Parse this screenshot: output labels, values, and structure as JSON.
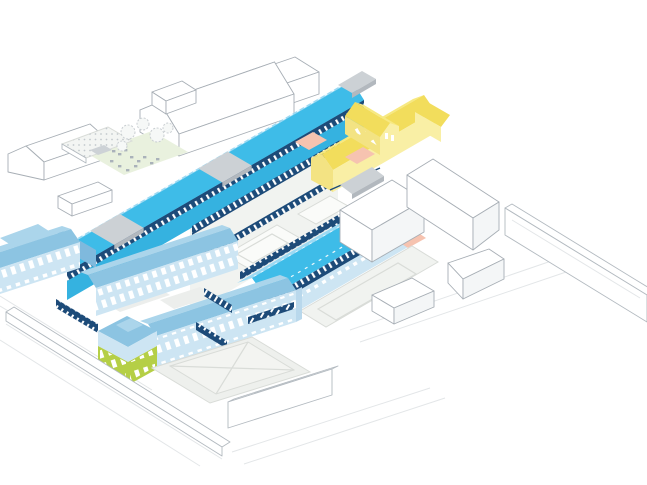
{
  "scene": {
    "kind": "axonometric architectural site diagram",
    "background": "#ffffff",
    "elements": [
      {
        "name": "spine-north",
        "label": "long skylit spine building (north)",
        "color_key": "cyan_roof"
      },
      {
        "name": "spine-south",
        "label": "long skylit spine building (south)",
        "color_key": "cyan_roof"
      },
      {
        "name": "chapel",
        "label": "cross-shaped chapel block",
        "color_key": "yellow_roof"
      },
      {
        "name": "heritage-complex",
        "label": "pale blue heritage wings with courtyards",
        "color_key": "blue_roof"
      },
      {
        "name": "corner-pavilion",
        "label": "corner pavilion with green base",
        "color_key": "green"
      },
      {
        "name": "gallery-court",
        "label": "colonnade galleries and white courts",
        "color_key": "navy"
      },
      {
        "name": "courtyard-x",
        "label": "paved courtyard with diagonal cross",
        "color_key": "court_x"
      },
      {
        "name": "terrace-courtyard",
        "label": "terrace with tables and planted roof",
        "color_key": "mint"
      },
      {
        "name": "salmon-patios",
        "label": "salmon entry patios",
        "color_key": "salmon"
      },
      {
        "name": "roof-links",
        "label": "grey flat roof links",
        "color_key": "gray_roof"
      },
      {
        "name": "context-buildings",
        "label": "white outlined context buildings",
        "color_key": "white"
      },
      {
        "name": "site-walls",
        "label": "perimeter walls and roads",
        "color_key": "white"
      }
    ]
  },
  "colors": {
    "white": "#ffffff",
    "cyan_roof": "#3ebce8",
    "cyan_roof_light": "#9bd9f3",
    "cyan_wall": "#35b2e0",
    "navy": "#1d4b79",
    "navy_dark": "#16395c",
    "paleblue": "#cde5f3",
    "paleblue_shade": "#b9d8ec",
    "blue_roof": "#8cc4e2",
    "blue_roof_light": "#abd5eb",
    "medium_blue": "#7fb9dd",
    "green": "#b5cf46",
    "yellow_roof": "#f2dd5c",
    "yellow_roof_light": "#f7e981",
    "yellow_wall": "#f9efa5",
    "yellow_wall_shade": "#f3e383",
    "salmon": "#f6c3b0",
    "gray_roof": "#ccd1d5",
    "gray_side": "#b2b8be",
    "mint": "#e9f1de",
    "platform": "#f1f3f0",
    "platform_inner": "#fafbf9",
    "court_x": "#eef0ed",
    "court_x_inner": "#f3f4f1",
    "path_gray": "#eceeec",
    "table_gray": "#aab2ba",
    "stair_gray": "#cdd2d6",
    "dotted_roof": "#f3f5f3"
  }
}
